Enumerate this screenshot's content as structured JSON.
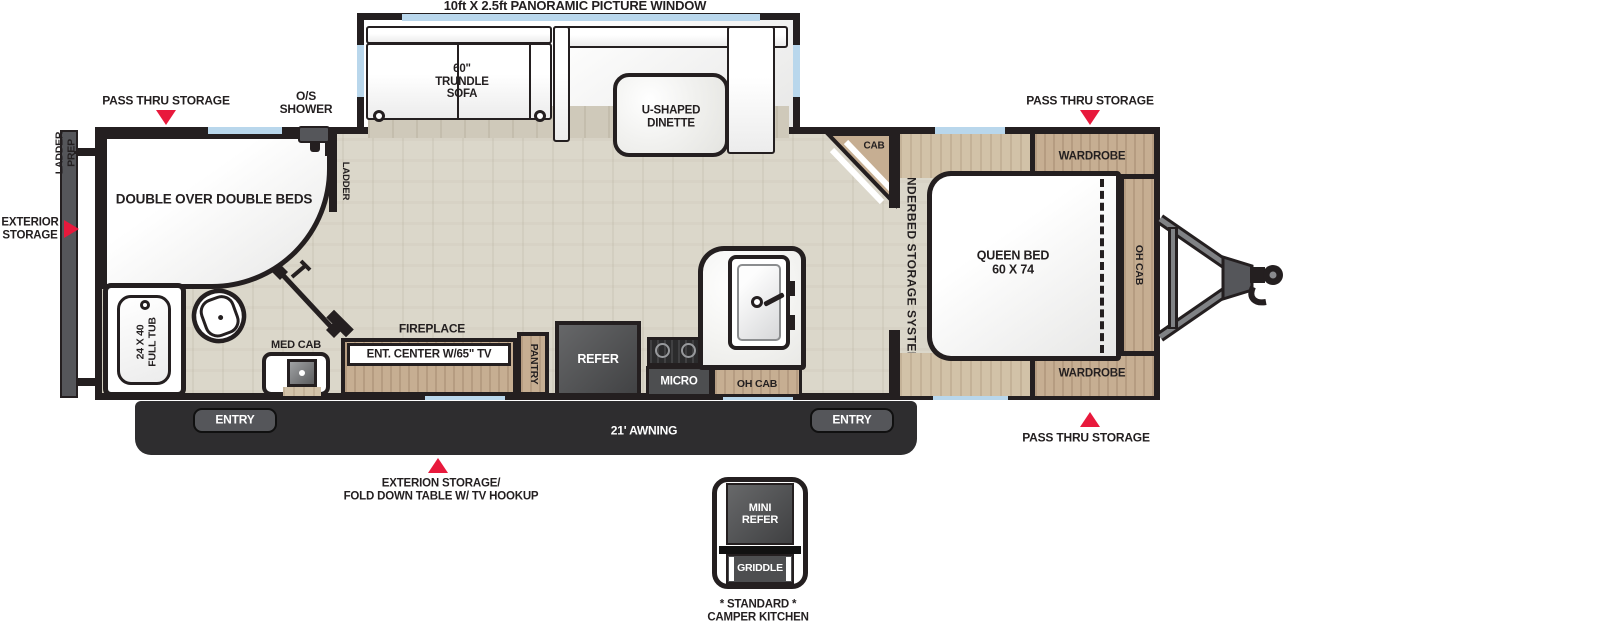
{
  "exterior": {
    "panoramic_window_label": "10ft X 2.5ft PANORAMIC PICTURE WINDOW",
    "pass_thru_storage_top_left": "PASS THRU STORAGE",
    "pass_thru_storage_top_right": "PASS THRU STORAGE",
    "pass_thru_storage_bottom_right": "PASS THRU STORAGE",
    "os_shower": "O/S\nSHOWER",
    "ladder_prep": "LADDER\nPREP",
    "exterior_storage": "EXTERIOR\nSTORAGE",
    "exterior_storage_fold_down": "EXTERION STORAGE/\nFOLD DOWN TABLE W/ TV HOOKUP",
    "awning": "21' AWNING",
    "entry_left": "ENTRY",
    "entry_right": "ENTRY"
  },
  "interior": {
    "trundle_sofa": "60\"\nTRUNDLE\nSOFA",
    "dinette": "U-SHAPED\nDINETTE",
    "double_beds": "DOUBLE OVER DOUBLE BEDS",
    "bunk_ladder": "LADDER",
    "tub": "24 X 40\nFULL TUB",
    "med_cab": "MED CAB",
    "fireplace": "FIREPLACE",
    "ent_center": "ENT. CENTER W/65\" TV",
    "pantry": "PANTRY",
    "refer": "REFER",
    "micro": "MICRO",
    "oh_cab_kitchen": "OH CAB",
    "cab": "CAB",
    "underbed_storage": "UNDERBED STORAGE SYSTEM",
    "queen_bed": "QUEEN BED\n60 X 74",
    "oh_cab_bedroom": "OH CAB",
    "wardrobe_top": "WARDROBE",
    "wardrobe_bottom": "WARDROBE"
  },
  "camper_kitchen": {
    "mini_refer": "MINI\nREFER",
    "griddle": "GRIDDLE",
    "caption": "* STANDARD *\nCAMPER KITCHEN"
  },
  "colors": {
    "wall": "#241f20",
    "floor": "#dbd7ca",
    "cabinet_wood": "#c6ae92",
    "appliance": "#4d4e50",
    "awning_band": "#2e2d2f",
    "window": "#b9d7ec",
    "arrow_red": "#e8193c"
  }
}
